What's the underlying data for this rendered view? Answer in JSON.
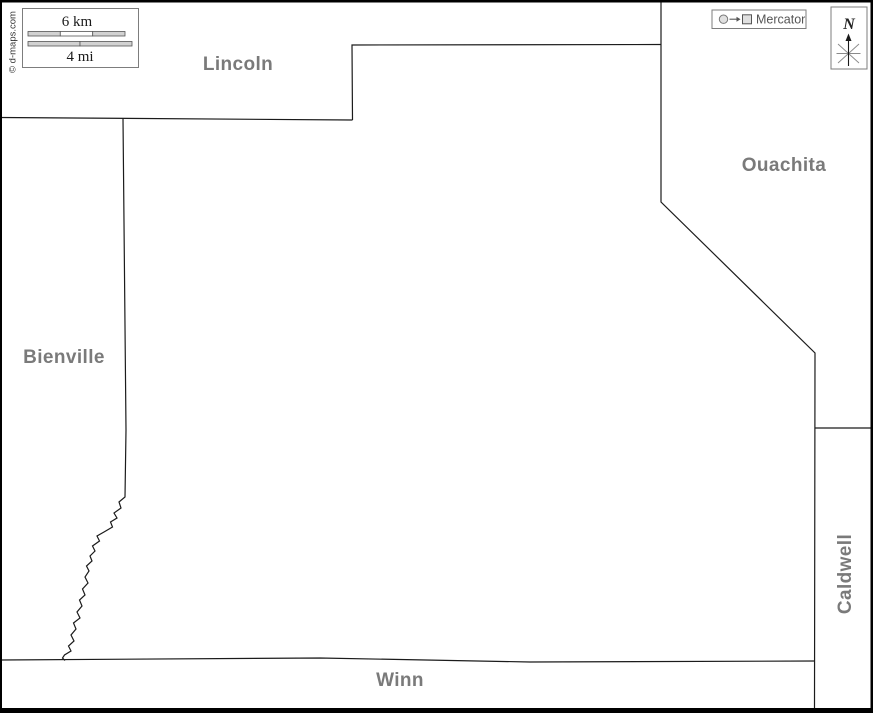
{
  "image": {
    "width": 873,
    "height": 713,
    "description": "Blank outline map of a parish with neighboring parishes labeled"
  },
  "copyright": "© d-maps.com",
  "scale_box": {
    "km_label": "6 km",
    "mi_label": "4 mi"
  },
  "projection_box": {
    "label": "Mercator"
  },
  "compass": {
    "north_label": "N"
  },
  "labels": {
    "lincoln": "Lincoln",
    "ouachita": "Ouachita",
    "bienville": "Bienville",
    "caldwell": "Caldwell",
    "winn": "Winn"
  },
  "colors": {
    "neighbor_label": "#7a7a7a",
    "boundary_line": "#1b1b1b",
    "frame_border": "#000000",
    "scale_bar_fill": "#d2d2d2",
    "icon_fill": "#e0e0e0",
    "projection_text": "#555555"
  }
}
